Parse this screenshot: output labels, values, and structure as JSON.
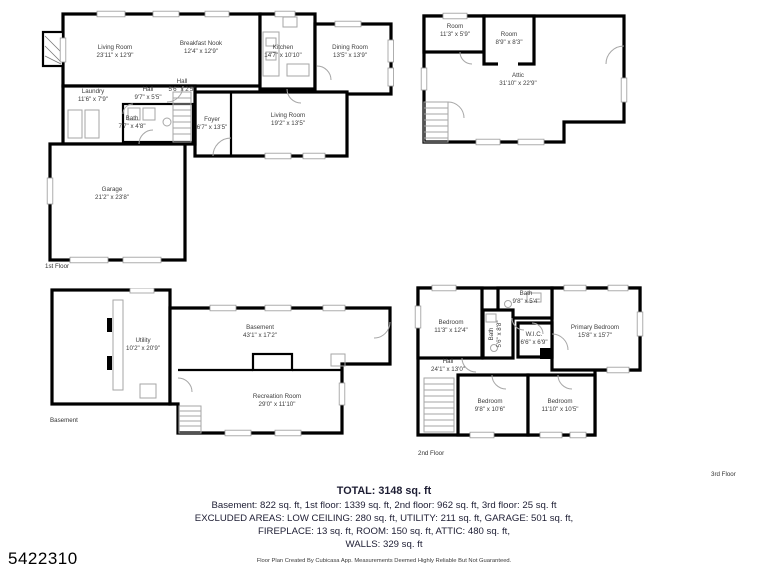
{
  "listing_id": "5422310",
  "footer_note": "Floor Plan Created By Cubicasa App. Measurements Deemed Highly Reliable But Not Guaranteed.",
  "summary": {
    "total": "TOTAL: 3148 sq. ft",
    "line1": "Basement: 822 sq. ft, 1st floor: 1339 sq. ft, 2nd floor: 962 sq. ft, 3rd floor: 25 sq. ft",
    "line2": "EXCLUDED AREAS: LOW CEILING: 280 sq. ft, UTILITY: 211 sq. ft, GARAGE: 501 sq. ft,",
    "line3": "FIREPLACE: 13 sq. ft, ROOM: 150 sq. ft, ATTIC: 480 sq. ft,",
    "line4": "WALLS: 329 sq. ft"
  },
  "colors": {
    "wall": "#000000",
    "fixture": "#a6a6a6",
    "label_text": "#3d3d3d",
    "summary_text": "#1d1d33"
  },
  "floors": {
    "first": {
      "label": "1st Floor",
      "rooms": {
        "living_room": {
          "name": "Living Room",
          "dims": "23'11\" x 12'9\""
        },
        "breakfast_nook": {
          "name": "Breakfast Nook",
          "dims": "12'4\" x 12'9\""
        },
        "kitchen": {
          "name": "Kitchen",
          "dims": "14'7\" x 10'10\""
        },
        "dining_room": {
          "name": "Dining Room",
          "dims": "13'5\" x 13'9\""
        },
        "laundry": {
          "name": "Laundry",
          "dims": "11'6\" x 7'9\""
        },
        "hall": {
          "name": "Hall",
          "dims": "9'7\" x 5'5\""
        },
        "hall_small": {
          "name": "Hall",
          "dims": "5'6\" x 2'5\""
        },
        "bath": {
          "name": "Bath",
          "dims": "7'7\" x 4'8\""
        },
        "foyer": {
          "name": "Foyer",
          "dims": "6'7\" x 13'5\""
        },
        "living_room_2": {
          "name": "Living Room",
          "dims": "19'2\" x 13'5\""
        },
        "garage": {
          "name": "Garage",
          "dims": "21'2\" x 23'8\""
        }
      }
    },
    "third": {
      "label": "3rd Floor",
      "rooms": {
        "room_1": {
          "name": "Room",
          "dims": "11'3\" x 5'9\""
        },
        "room_2": {
          "name": "Room",
          "dims": "8'9\" x 8'3\""
        },
        "attic": {
          "name": "Attic",
          "dims": "31'10\" x 22'9\""
        }
      }
    },
    "basement": {
      "label": "Basement",
      "rooms": {
        "utility": {
          "name": "Utility",
          "dims": "10'2\" x 20'9\""
        },
        "basement": {
          "name": "Basement",
          "dims": "43'1\" x 17'2\""
        },
        "recreation_room": {
          "name": "Recreation Room",
          "dims": "29'0\" x 11'10\""
        }
      }
    },
    "second": {
      "label": "2nd Floor",
      "rooms": {
        "bedroom_1": {
          "name": "Bedroom",
          "dims": "11'3\" x 12'4\""
        },
        "bath_1": {
          "name": "Bath",
          "dims": "9'8\" x 5'4\""
        },
        "bath_2": {
          "name": "Bath",
          "dims": "5'6\" x 8'8\""
        },
        "wic": {
          "name": "W.I.C.",
          "dims": "6'6\" x 6'9\""
        },
        "primary_bedroom": {
          "name": "Primary Bedroom",
          "dims": "15'8\" x 15'7\""
        },
        "hall": {
          "name": "Hall",
          "dims": "24'1\" x 13'0\""
        },
        "bedroom_2": {
          "name": "Bedroom",
          "dims": "9'8\" x 10'6\""
        },
        "bedroom_3": {
          "name": "Bedroom",
          "dims": "11'10\" x 10'5\""
        }
      }
    }
  }
}
